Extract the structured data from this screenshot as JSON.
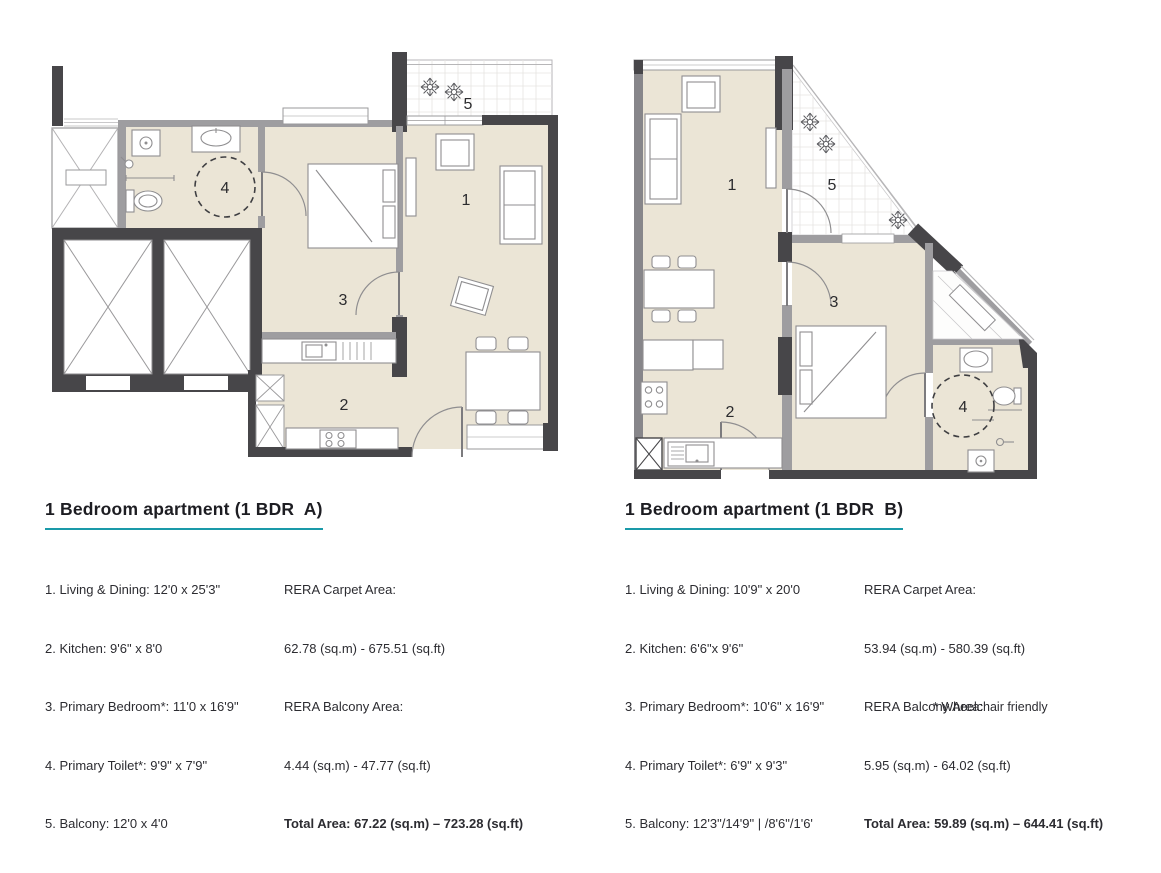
{
  "theme": {
    "accent": "#1a9aa9",
    "wall_dark": "#474649",
    "wall_gray": "#9e9da0",
    "floor": "#ebe5d6",
    "text": "#26262b"
  },
  "footnote": "* Wheelchair friendly",
  "plans": [
    {
      "title": "1 Bedroom apartment (1 BDR  A)",
      "room_lines": [
        "1. Living & Dining: 12'0 x 25'3\"",
        "2. Kitchen: 9'6\" x 8'0",
        "3. Primary Bedroom*: 11'0 x 16'9\"",
        "4. Primary Toilet*: 9'9\" x 7'9\"",
        "5. Balcony: 12'0 x 4'0"
      ],
      "area_lines": [
        "RERA Carpet Area:",
        "62.78 (sq.m) - 675.51 (sq.ft)",
        "RERA Balcony Area:",
        "4.44 (sq.m) - 47.77 (sq.ft)",
        "Total Area: 67.22 (sq.m) – 723.28 (sq.ft)"
      ],
      "labels": {
        "living": "1",
        "kitchen": "2",
        "bedroom": "3",
        "toilet": "4",
        "balcony": "5"
      }
    },
    {
      "title": "1 Bedroom apartment (1 BDR  B)",
      "room_lines": [
        "1. Living & Dining: 10'9\" x 20'0",
        "2. Kitchen: 6'6\"x 9'6\"",
        "3. Primary Bedroom*: 10'6\" x 16'9\"",
        "4. Primary Toilet*: 6'9\" x 9'3\"",
        "5. Balcony: 12'3\"/14'9\" | /8'6\"/1'6'"
      ],
      "area_lines": [
        "RERA Carpet Area:",
        "53.94 (sq.m) - 580.39 (sq.ft)",
        "RERA Balcony Area:",
        "5.95 (sq.m) - 64.02 (sq.ft)",
        "Total Area: 59.89 (sq.m) – 644.41 (sq.ft)"
      ],
      "labels": {
        "living": "1",
        "kitchen": "2",
        "bedroom": "3",
        "toilet": "4",
        "balcony": "5"
      }
    }
  ]
}
